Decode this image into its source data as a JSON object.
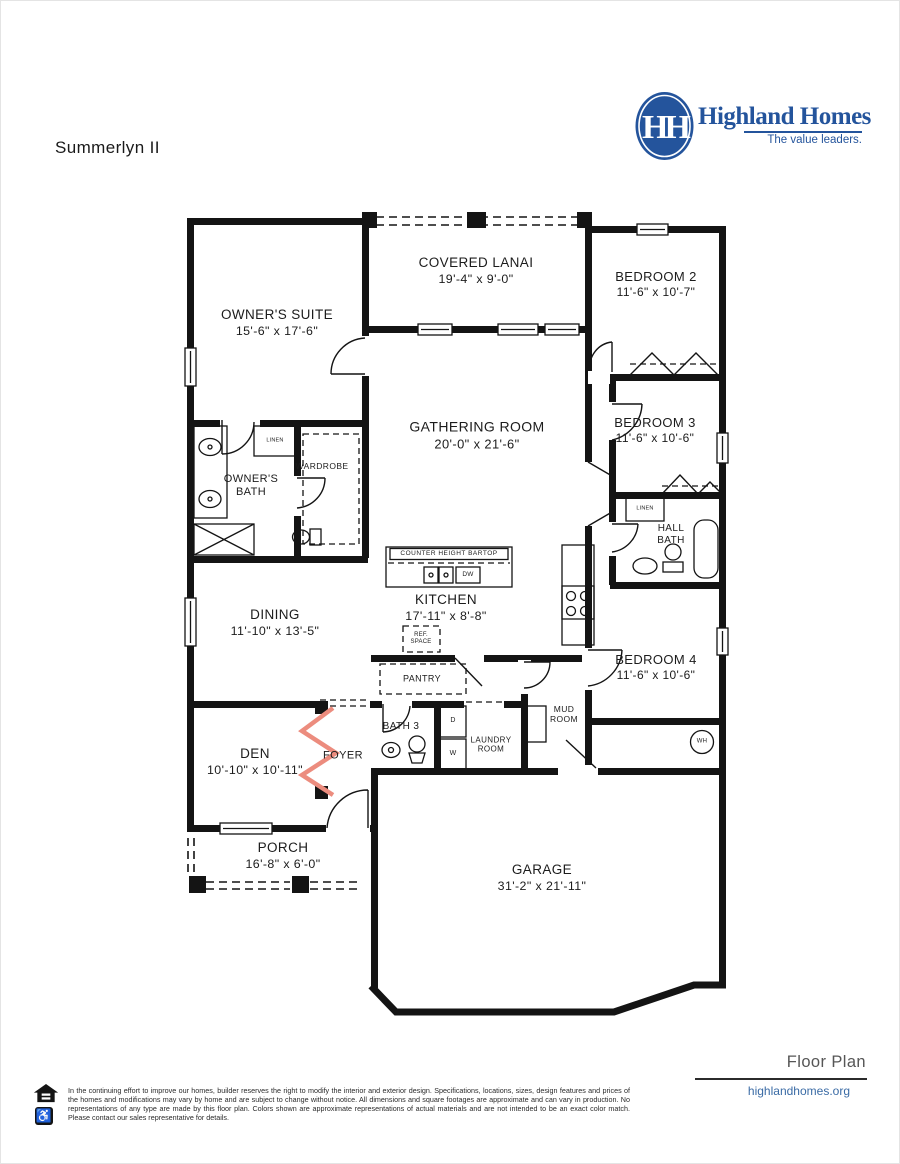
{
  "header": {
    "plan_name": "Summerlyn II"
  },
  "brand": {
    "name": "Highland Homes",
    "tagline": "The value leaders.",
    "monogram": "HH",
    "colors": {
      "brand_blue": "#24549C",
      "link_blue": "#3A6BA5",
      "optional_wall_red": "#EC8C7E",
      "wall_black": "#141414",
      "muted_gray": "#565656"
    }
  },
  "rooms": {
    "lanai": {
      "name": "COVERED LANAI",
      "dims": "19'-4\" x 9'-0\""
    },
    "bedroom2": {
      "name": "BEDROOM 2",
      "dims": "11'-6\" x 10'-7\""
    },
    "owners_suite": {
      "name": "OWNER'S SUITE",
      "dims": "15'-6\" x 17'-6\""
    },
    "gathering": {
      "name": "GATHERING ROOM",
      "dims": "20'-0\" x 21'-6\""
    },
    "bedroom3": {
      "name": "BEDROOM 3",
      "dims": "11'-6\" x 10'-6\""
    },
    "owners_bath": {
      "name": "OWNER'S BATH"
    },
    "wardrobe": {
      "name": "WARDROBE"
    },
    "hall_bath": {
      "name": "HALL BATH"
    },
    "kitchen": {
      "name": "KITCHEN",
      "dims": "17'-11\" x 8'-8\""
    },
    "dining": {
      "name": "DINING",
      "dims": "11'-10\" x 13'-5\""
    },
    "bedroom4": {
      "name": "BEDROOM 4",
      "dims": "11'-6\" x 10'-6\""
    },
    "pantry": {
      "name": "PANTRY"
    },
    "mud_room": {
      "name": "MUD ROOM"
    },
    "bath3": {
      "name": "BATH 3"
    },
    "laundry": {
      "name": "LAUNDRY ROOM"
    },
    "den": {
      "name": "DEN",
      "dims": "10'-10\" x 10'-11\""
    },
    "foyer": {
      "name": "FOYER"
    },
    "porch": {
      "name": "PORCH",
      "dims": "16'-8\" x 6'-0\""
    },
    "garage": {
      "name": "GARAGE",
      "dims": "31'-2\" x 21'-11\""
    }
  },
  "labels": {
    "counter_bartop": "COUNTER HEIGHT BARTOP",
    "linen_owner": "LINEN",
    "linen_hall": "LINEN",
    "ref_space": "REF. SPACE",
    "dishwasher": "DW",
    "dryer": "D",
    "washer": "W",
    "water_heater": "WH"
  },
  "footer": {
    "plan_type": "Floor Plan",
    "website": "highlandhomes.org",
    "disclaimer": "In the continuing effort to improve our homes, builder reserves the right to modify the interior and exterior design. Specifications, locations, sizes, design features and prices of the homes and modifications may vary by home and are subject to change without notice. All dimensions and square footages are approximate and can vary in production. No representations of any type are made by this floor plan. Colors shown are approximate representations of actual materials and are not intended to be an exact color match. Please contact our sales representative for details.",
    "icons": {
      "accessibility": "♿"
    }
  }
}
